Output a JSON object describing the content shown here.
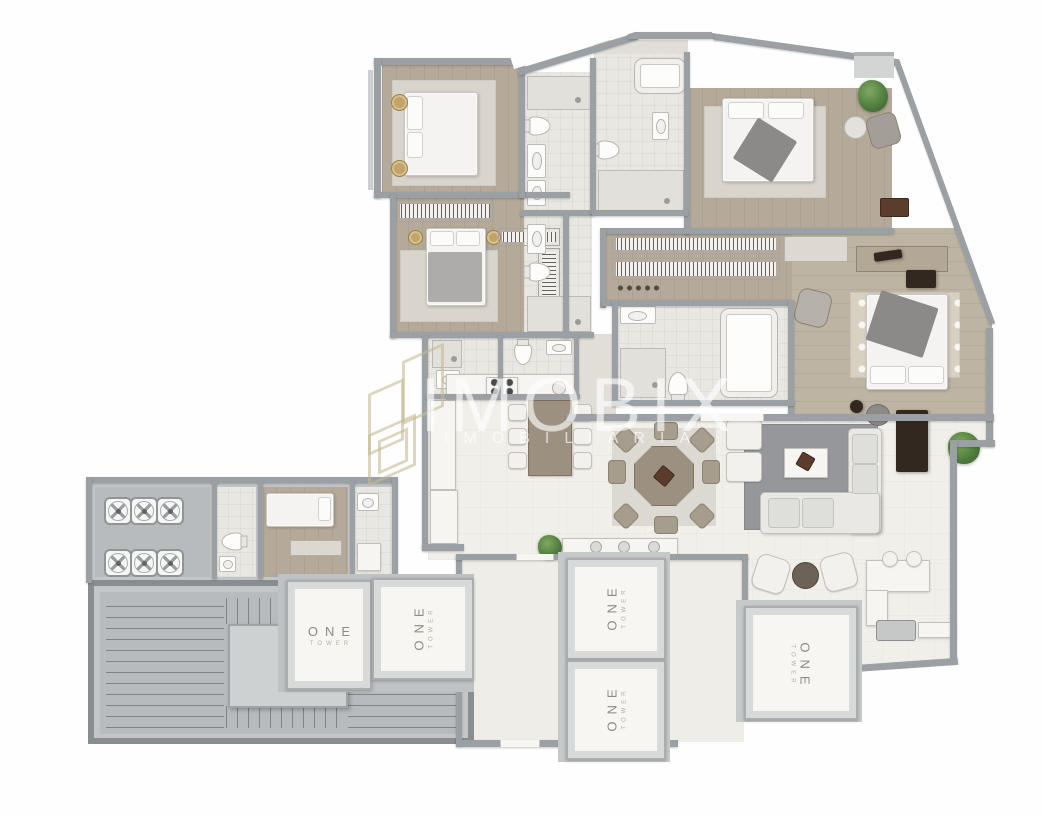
{
  "watermark": {
    "brand": "IMOBIX",
    "subtitle": "IMOBILIÁRIA"
  },
  "elevators": [
    {
      "id": "elevator-1",
      "label": "ONE",
      "sublabel": "TOWER"
    },
    {
      "id": "elevator-2",
      "label": "ONE",
      "sublabel": "TOWER"
    },
    {
      "id": "elevator-3",
      "label": "ONE",
      "sublabel": "TOWER"
    },
    {
      "id": "elevator-4",
      "label": "ONE",
      "sublabel": "TOWER"
    },
    {
      "id": "elevator-5",
      "label": "ONE",
      "sublabel": "TOWER"
    }
  ],
  "colors": {
    "wall": "#9aa0a3",
    "wall-dark": "#888d90",
    "wood": "#b5aa99",
    "wood2": "#beb4a3",
    "tile": "#e9e7e2",
    "social": "#f1efe9",
    "hall": "#e0ded7",
    "white-floor": "#efede7",
    "dining-pad": "#dcd9d2",
    "common": "#c3c6c8",
    "stair": "#b7bbbd",
    "landing": "#ced1d2",
    "silver": "#d8dada",
    "band": "#b2a695",
    "cab": "#f7f6f3",
    "label": "#8a8a86",
    "sub": "#b8b1a3",
    "gold": "#c7b890",
    "green": "#4d7a3a",
    "rug": "#95979b",
    "sofa": "#e9e8e5",
    "dark": "#33281f",
    "brown": "#5a3d2c"
  }
}
